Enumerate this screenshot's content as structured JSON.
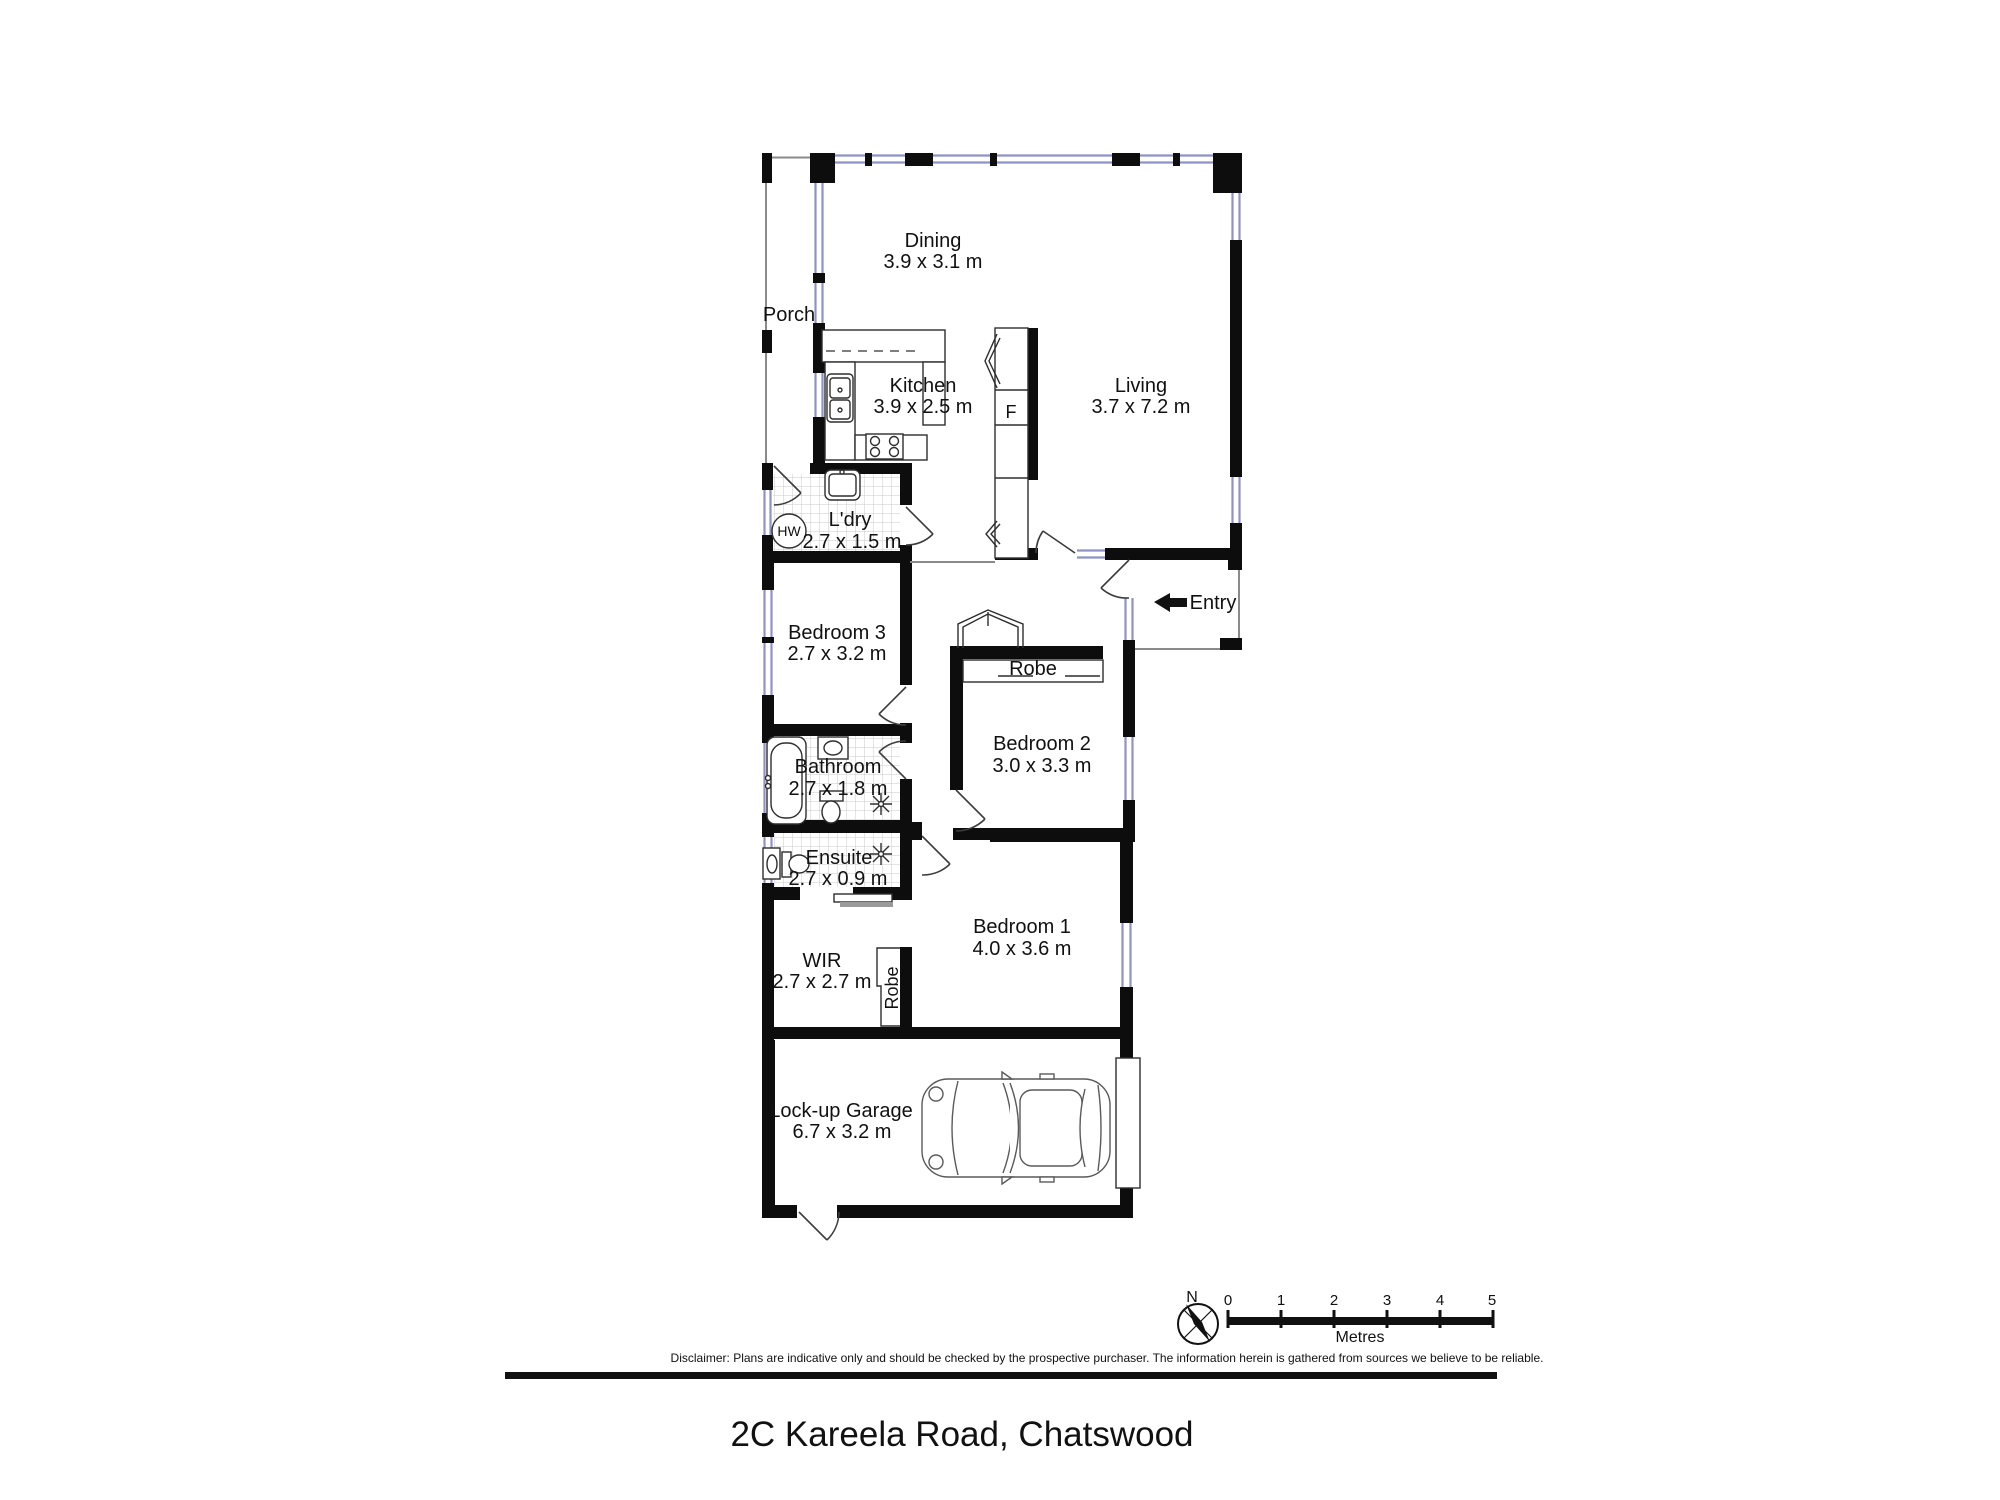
{
  "title": {
    "address": "2C Kareela Road, Chatswood"
  },
  "rooms": {
    "dining": {
      "name": "Dining",
      "dims": "3.9 x 3.1 m"
    },
    "porch": {
      "name": "Porch"
    },
    "kitchen": {
      "name": "Kitchen",
      "dims": "3.9 x 2.5 m"
    },
    "living": {
      "name": "Living",
      "dims": "3.7 x 7.2 m"
    },
    "laundry": {
      "name": "L'dry",
      "dims": "2.7 x 1.5 m"
    },
    "bedroom3": {
      "name": "Bedroom 3",
      "dims": "2.7 x 3.2 m"
    },
    "bedroom2": {
      "name": "Bedroom 2",
      "dims": "3.0 x 3.3 m"
    },
    "bathroom": {
      "name": "Bathroom",
      "dims": "2.7 x 1.8 m"
    },
    "ensuite": {
      "name": "Ensuite",
      "dims": "2.7 x 0.9 m"
    },
    "bedroom1": {
      "name": "Bedroom 1",
      "dims": "4.0 x 3.6 m"
    },
    "wir": {
      "name": "WIR",
      "dims": "2.7 x 2.7 m"
    },
    "garage": {
      "name": "Lock-up Garage",
      "dims": "6.7 x 3.2 m"
    }
  },
  "features": {
    "entry": "Entry",
    "robe_bed2": "Robe",
    "robe_bed1": "Robe",
    "fridge": "F",
    "hot_water": "HW"
  },
  "compass": {
    "north": "N"
  },
  "scale_bar": {
    "ticks": [
      "0",
      "1",
      "2",
      "3",
      "4",
      "5"
    ],
    "unit": "Metres"
  },
  "disclaimer": "Disclaimer: Plans are indicative only and should be checked by the prospective purchaser. The information herein is gathered from sources we believe to be reliable.",
  "colors": {
    "wall": "#0d0d0d",
    "window": "#8f92c6",
    "tile": "#c9c9c9",
    "text": "#111111"
  }
}
